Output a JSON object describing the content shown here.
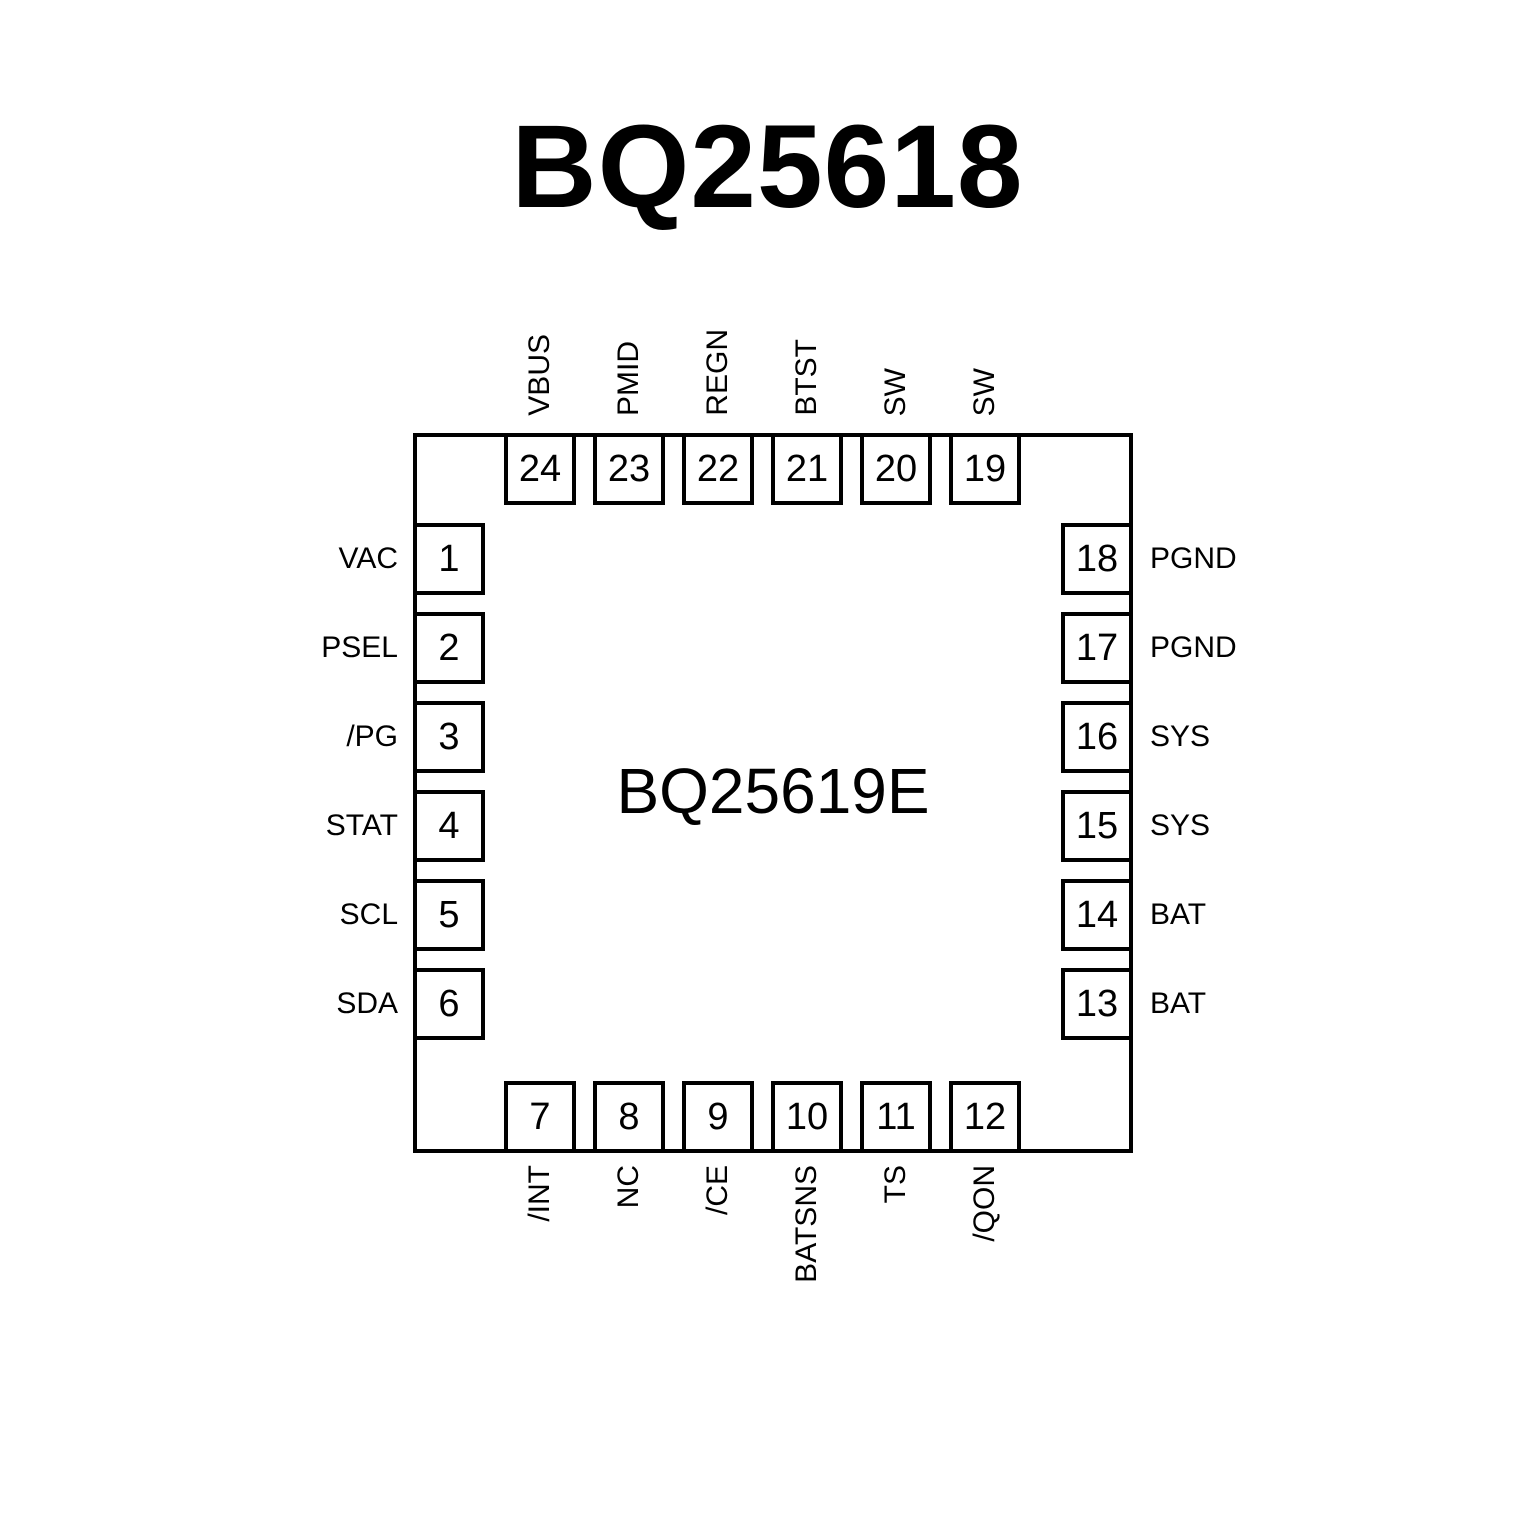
{
  "page": {
    "title": "BQ25618"
  },
  "chip": {
    "center_label": "BQ25619E",
    "package_pin_count": 24,
    "pins": {
      "top": [
        {
          "number": "24",
          "label": "VBUS"
        },
        {
          "number": "23",
          "label": "PMID"
        },
        {
          "number": "22",
          "label": "REGN"
        },
        {
          "number": "21",
          "label": "BTST"
        },
        {
          "number": "20",
          "label": "SW"
        },
        {
          "number": "19",
          "label": "SW"
        }
      ],
      "left": [
        {
          "number": "1",
          "label": "VAC"
        },
        {
          "number": "2",
          "label": "PSEL"
        },
        {
          "number": "3",
          "label": "/PG"
        },
        {
          "number": "4",
          "label": "STAT"
        },
        {
          "number": "5",
          "label": "SCL"
        },
        {
          "number": "6",
          "label": "SDA"
        }
      ],
      "right": [
        {
          "number": "18",
          "label": "PGND"
        },
        {
          "number": "17",
          "label": "PGND"
        },
        {
          "number": "16",
          "label": "SYS"
        },
        {
          "number": "15",
          "label": "SYS"
        },
        {
          "number": "14",
          "label": "BAT"
        },
        {
          "number": "13",
          "label": "BAT"
        }
      ],
      "bottom": [
        {
          "number": "7",
          "label": "/INT"
        },
        {
          "number": "8",
          "label": "NC"
        },
        {
          "number": "9",
          "label": "/CE"
        },
        {
          "number": "10",
          "label": "BATSNS"
        },
        {
          "number": "11",
          "label": "TS"
        },
        {
          "number": "12",
          "label": "/QON"
        }
      ]
    }
  },
  "colors": {
    "line": "#000000",
    "text": "#000000",
    "background": "#ffffff"
  }
}
